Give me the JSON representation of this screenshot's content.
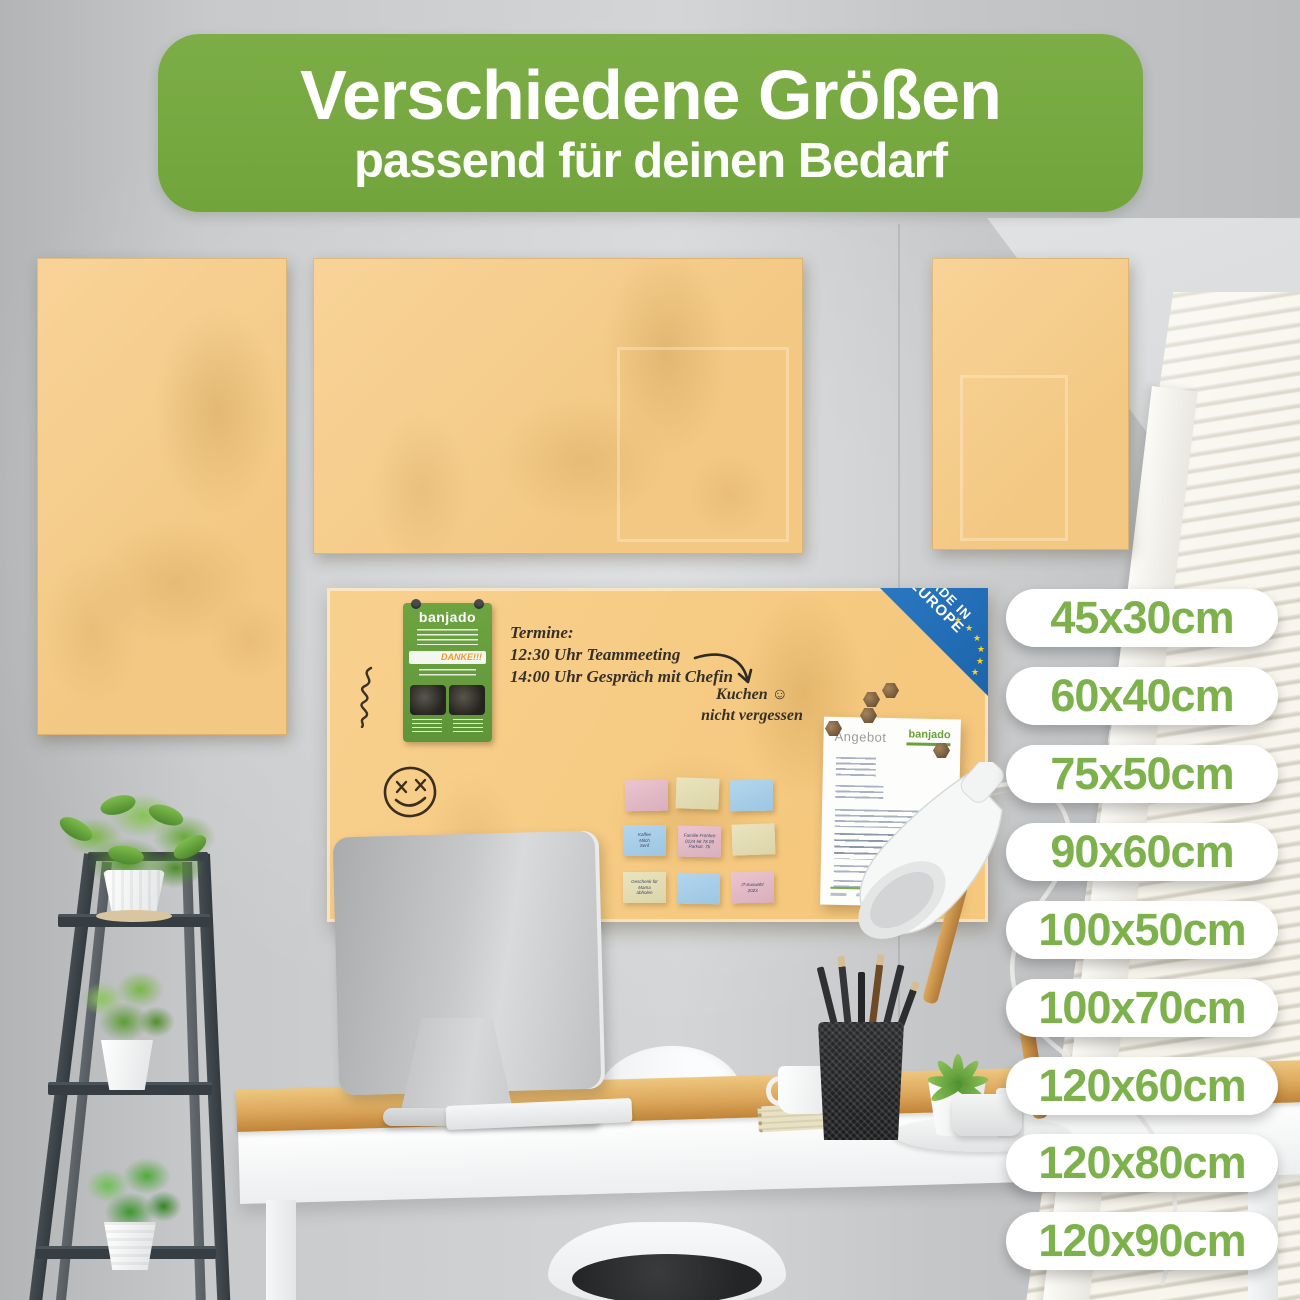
{
  "header": {
    "title": "Verschiedene Größen",
    "subtitle": "passend für deinen Bedarf"
  },
  "sizes": {
    "labels": [
      "45x30cm",
      "60x40cm",
      "75x50cm",
      "90x60cm",
      "100x50cm",
      "100x70cm",
      "120x60cm",
      "120x80cm",
      "120x90cm"
    ]
  },
  "board_markings": {
    "schedule_title": "Termine:",
    "schedule_line1": "12:30 Uhr Teammeeting",
    "schedule_line2": "14:00 Uhr Gespräch mit Chefin",
    "reminder_line1": "Kuchen",
    "reminder_line2": "nicht vergessen",
    "reminder_smiley": "☺"
  },
  "badge": {
    "line1": "MADE IN",
    "line2": "EUROPE",
    "star": "★"
  },
  "hang_tag": {
    "brand": "banjado",
    "thanks": "DANKE!!!"
  },
  "offer_paper": {
    "title": "Angebot",
    "brand": "banjado"
  },
  "sticky_notes": [
    {
      "color": "pink",
      "lines": []
    },
    {
      "color": "cream",
      "lines": []
    },
    {
      "color": "blue",
      "lines": []
    },
    {
      "color": "blue",
      "lines": [
        "Kaffee",
        "Milch",
        "Senf"
      ]
    },
    {
      "color": "pink",
      "lines": [
        "Familie Fröhlich",
        "0124 56 78 09",
        "Parkstr. 7b"
      ]
    },
    {
      "color": "cream",
      "lines": []
    },
    {
      "color": "cream",
      "lines": [
        "Geschenk für",
        "Mama",
        "abholen"
      ]
    },
    {
      "color": "blue",
      "lines": []
    },
    {
      "color": "pink",
      "lines": [
        "IT-Auswahl",
        "2023"
      ]
    }
  ],
  "colors": {
    "banner_green": "#76a840",
    "pill_text_green": "#7cb14b",
    "board_orange": "#f6cd8d",
    "badge_blue": "#1e69b2",
    "star_yellow": "#ffd41f",
    "tag_green": "#68a136",
    "desk_wood": "#dfae63"
  }
}
